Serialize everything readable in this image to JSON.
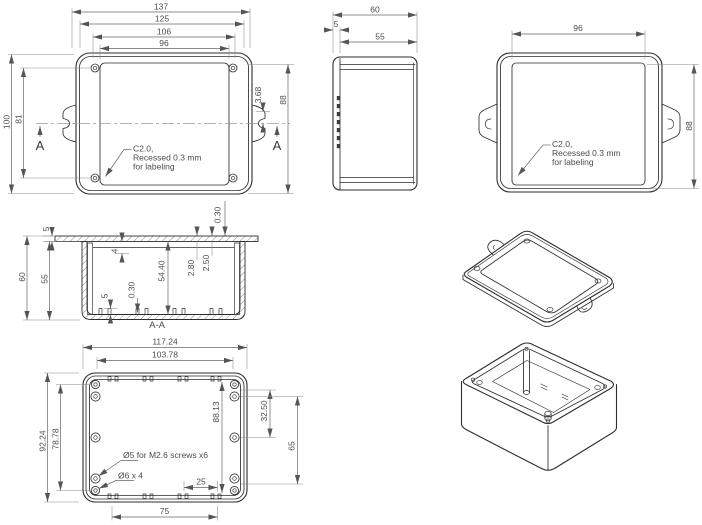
{
  "views": {
    "front": {
      "flange_width": "137",
      "body_width": "125",
      "recess_width": "106",
      "panel_width": "96",
      "body_height": "100",
      "hole_spacing": "81",
      "slot_offset": "3.68",
      "panel_height": "88"
    },
    "side": {
      "total_depth": "60",
      "lid_depth": "5",
      "body_depth": "55"
    },
    "back": {
      "panel_width": "96",
      "panel_height": "88"
    },
    "section": {
      "label": "A-A",
      "lid_thickness": "5",
      "total_depth": "60",
      "body_depth": "55",
      "top_rib_depth": "4",
      "inner_depth": "54.40",
      "boss_height": "5",
      "rib_height": "0.30",
      "recess_depth": "0.30",
      "step_a": "2.80",
      "step_b": "2.50"
    },
    "bottom": {
      "outer_width": "117.24",
      "inner_width": "103.78",
      "outer_height": "92.24",
      "hole_spacing_v": "78.78",
      "inner_height": "88.13",
      "boss_offset": "32.50",
      "boss_spacing": "65",
      "rib_offset": "25",
      "rib_spacing": "75",
      "note_bosses": "Ø5 for M2.6 screws x6",
      "note_corner_holes": "Ø6 x 4"
    },
    "shared": {
      "section_letter": "A",
      "label_note_1": "C2.0,",
      "label_note_2": "Recessed 0.3 mm",
      "label_note_3": "for labeling"
    }
  }
}
